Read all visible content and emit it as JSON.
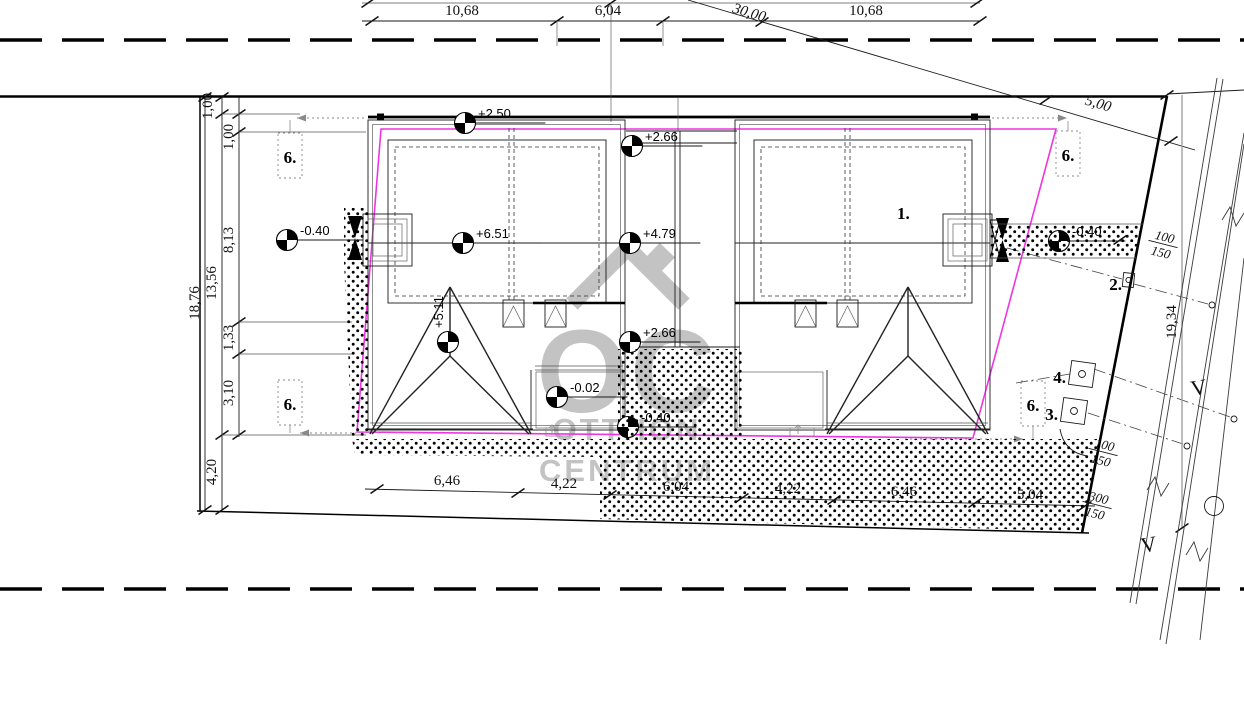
{
  "watermark": {
    "logo": "OC",
    "line1": "OTTHON",
    "line2": "CENTRUM"
  },
  "dims": {
    "top": {
      "d1": "10,68",
      "d2": "6,04",
      "d3": "10,68"
    },
    "diagonal": {
      "d30": "30,00",
      "d5": "5,00"
    },
    "left": {
      "a1": "1,00",
      "a2": "1,00",
      "a3": "8,13",
      "a4": "1,33",
      "a5": "3,10",
      "sub": "13,56",
      "total": "18,76",
      "front": "4,20"
    },
    "bottom": {
      "b1": "6,46",
      "b2": "4,22",
      "b3": "6,04",
      "b4": "4,22",
      "b5": "6,46",
      "b6": "5,04"
    },
    "right": {
      "depth": "19,34"
    }
  },
  "elevations": {
    "eave_left": "+2.50",
    "fence_top": "+2.66",
    "ridge_left": "+6.51",
    "ridge_mid": "+4.79",
    "wing_ridge": "+5.11",
    "fence_mid": "+2.66",
    "terrace": "-0.02",
    "walk_mid": "-0.40",
    "walk_left": "-0.40",
    "walk_right": "-0.40"
  },
  "labels": {
    "house": "1.",
    "p2": "2.",
    "p3": "3.",
    "p4": "4.",
    "c6a": "6.",
    "c6b": "6.",
    "c6c": "6.",
    "c6d": "6."
  },
  "utilities": {
    "v1": "V",
    "v2": "V",
    "f1n": "100",
    "f1d": "150",
    "f2n": "100",
    "f2d": "150",
    "f3n": "300",
    "f3d": "150"
  },
  "colors": {
    "envelope": "#ee35e4",
    "watermark": "#c3c3c3",
    "ink": "#111111"
  }
}
